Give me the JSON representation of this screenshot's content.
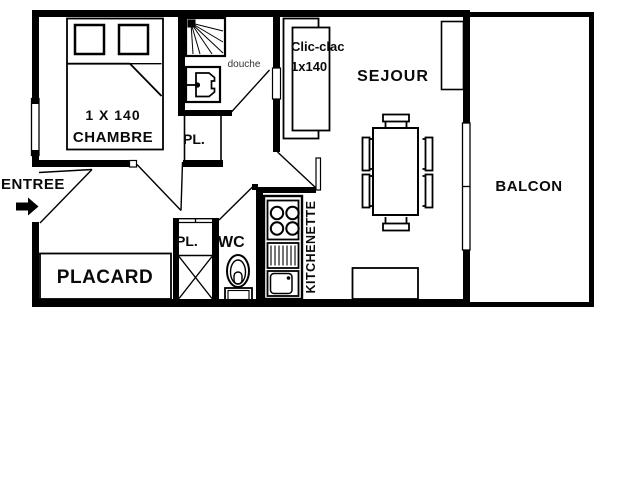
{
  "plan": {
    "type": "apartment-floor-plan",
    "colors": {
      "ink": "#000000",
      "background": "#ffffff"
    },
    "rooms": {
      "chambre": {
        "label": "CHAMBRE",
        "bed_size": "1 X 140"
      },
      "douche": {
        "label": "douche"
      },
      "pl_upper": {
        "label": "PL."
      },
      "pl_lower": {
        "label": "PL."
      },
      "wc": {
        "label": "WC"
      },
      "placard": {
        "label": "PLACARD"
      },
      "kitchenette": {
        "label": "KITCHENETTE"
      },
      "sejour": {
        "label": "SEJOUR"
      },
      "balcon": {
        "label": "BALCON"
      },
      "entree": {
        "label": "ENTREE"
      }
    },
    "furniture": {
      "sofa_bed_line1": "Clic-clac",
      "sofa_bed_line2": "1x140"
    }
  }
}
